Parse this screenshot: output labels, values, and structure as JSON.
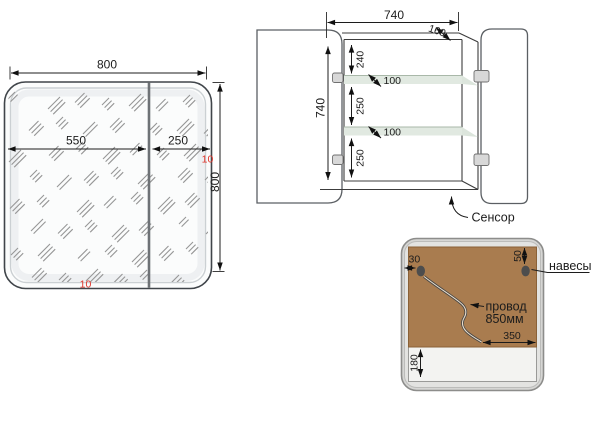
{
  "front_view": {
    "width_dim": "800",
    "height_dim": "800",
    "door_left_dim": "550",
    "door_right_dim": "250",
    "offset_right": "10",
    "offset_bottom": "10"
  },
  "cabinet_view": {
    "width_dim": "740",
    "depth_dim": "160",
    "height_dim": "740",
    "top_gap": "240",
    "mid_gap": "250",
    "bottom_gap": "250",
    "shelf_depth_top": "100",
    "shelf_depth_bottom": "100",
    "sensor_label": "Сенсор"
  },
  "back_view": {
    "hanger_offset_side": "30",
    "hanger_offset_top": "50",
    "hangers_label": "навесы",
    "wire_label": "провод",
    "wire_length": "850мм",
    "wire_exit_offset": "350",
    "bottom_margin": "180"
  },
  "colors": {
    "dim_red": "#e0352b",
    "panel_brown": "#a97c4f",
    "shelf_glass": "#e1e9e1",
    "frame_silver": "#d6d6d4"
  }
}
